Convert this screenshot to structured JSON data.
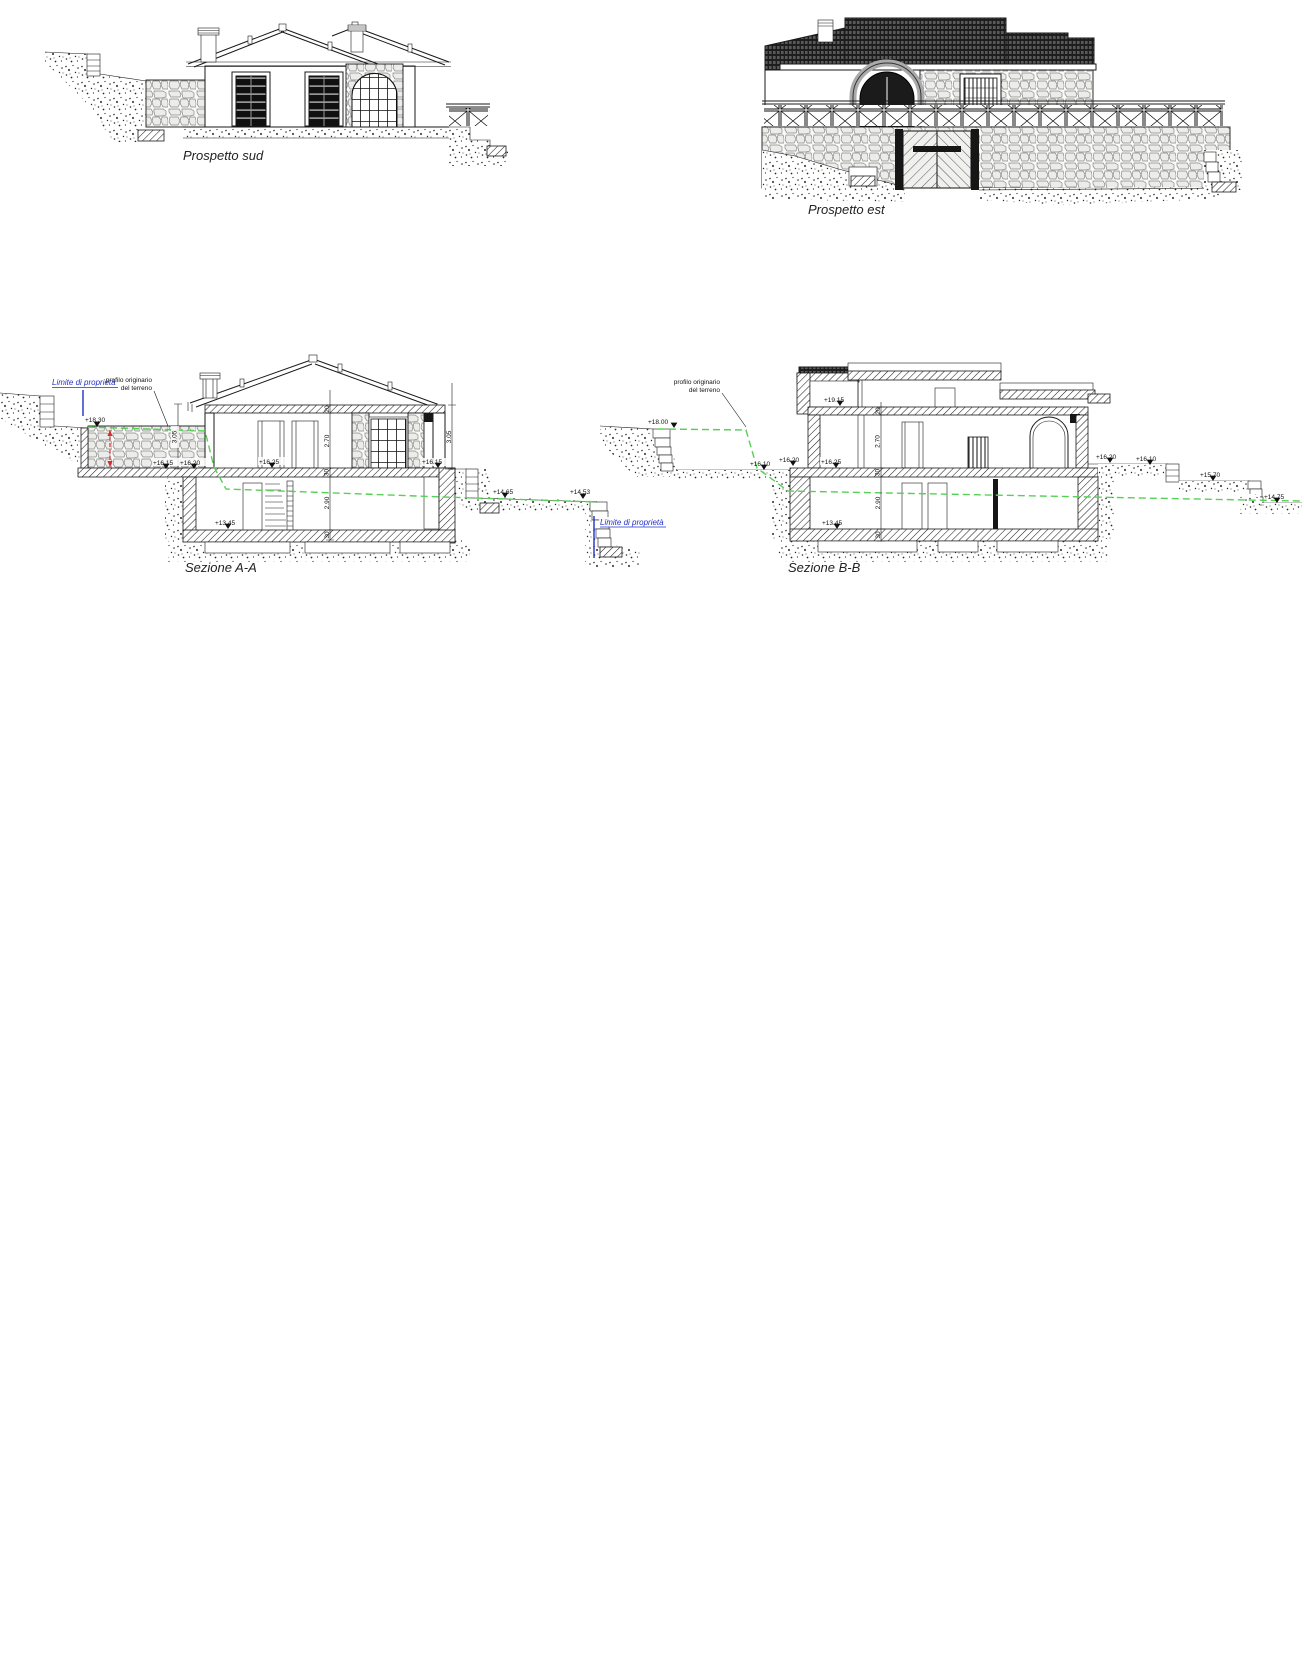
{
  "sheet": {
    "background": "#ffffff"
  },
  "colors": {
    "ink": "#1a1a1a",
    "terrain_profile_green": "#57d057",
    "property_limit_blue": "#2230c8",
    "red_dimension": "#d03030"
  },
  "prospetto_sud": {
    "title": "Prospetto sud"
  },
  "prospetto_est": {
    "title": "Prospetto est"
  },
  "sezione_aa": {
    "title": "Sezione A-A",
    "limite_left": "Limite di proprietà",
    "limite_right": "Limite di proprietà",
    "profilo_line1": "profilo originario",
    "profilo_line2": "del terreno",
    "levels": {
      "muro_top": "+18.30",
      "ground_wall_a": "+16.15",
      "ground_wall_b": "+16.20",
      "piano_terra": "+16.25",
      "ground_right": "+16.15",
      "terrazzo_mid": "+14.65",
      "terrazzo_low": "+14.53",
      "interrato": "+13.45"
    },
    "dims": {
      "solaio_top": "20",
      "altezza_piano": "2.70",
      "solaio_mid": "30",
      "altezza_interrato": "2.90",
      "solaio_fondo": "30",
      "altezza_esterna_sx": "3.05",
      "altezza_esterna_dx": "3.05"
    }
  },
  "sezione_bb": {
    "title": "Sezione B-B",
    "profilo_line1": "profilo originario",
    "profilo_line2": "del terreno",
    "levels": {
      "ground_upper_left": "+18.00",
      "sottotetto": "+19.15",
      "ground_left_a": "+16.10",
      "ground_left_b": "+16.20",
      "piano_terra": "+16.25",
      "interrato": "+13.45",
      "ground_right_a": "+16.20",
      "ground_right_b": "+16.10",
      "terrazzo_mid": "+15.70",
      "terrazzo_low": "+14.75"
    },
    "dims": {
      "solaio_top": "20",
      "altezza_piano": "2.70",
      "solaio_mid": "30",
      "altezza_interrato": "2.90",
      "solaio_fondo": "30"
    }
  }
}
